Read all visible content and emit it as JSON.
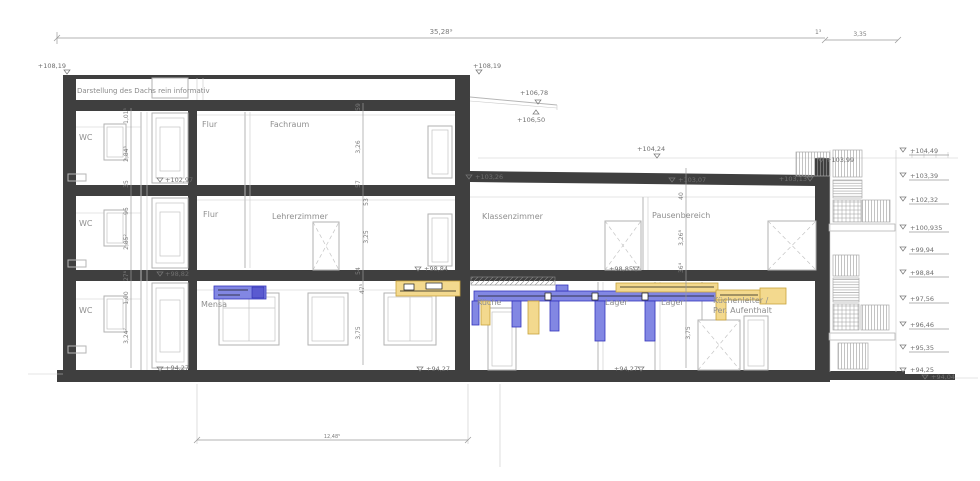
{
  "note": "Darstellung des Dachs rein informativ",
  "colors": {
    "wall": "#3f3f3f",
    "duct_supply_blue": "#8287e3",
    "duct_exhaust_yellow": "#f3d98e",
    "line_gray": "#b6b6b6"
  },
  "dims": {
    "top_main": "35,28⁹",
    "top_small": "1³",
    "top_right": "3,35",
    "bottom": "12,48⁵",
    "left": [
      "1,01⁵",
      "2,84⁵",
      "35",
      "95",
      "2,85²",
      "27⁸",
      "1,00",
      "3,24⁷"
    ],
    "mid": [
      "59",
      "3,26",
      "57",
      "53",
      "3,25",
      "54",
      "47⁵",
      "3,75"
    ],
    "right": [
      "40",
      "3,26⁸",
      "36⁴",
      "3,75"
    ]
  },
  "rooms": {
    "wc": "WC",
    "flur": "Flur",
    "fachraum": "Fachraum",
    "lehrerzimmer": "Lehrerzimmer",
    "klassenzimmer": "Klassenzimmer",
    "pausenbereich": "Pausenbereich",
    "mensa": "Mensa",
    "kueche": "Küche",
    "lager": "Lager",
    "kuechenleiter1": "Küchenleiter /",
    "kuechenleiter2": "Per. Aufenthalt"
  },
  "levels": {
    "parapet": "+108,19",
    "canopy_top": "+106,78",
    "canopy_bot": "+106,50",
    "roof2": "+104,24",
    "slab2_l": "+103,26",
    "slab2_m": "+103,07",
    "slab2_r": "+103,13",
    "stair_top": "+103,99",
    "stair_l1": "+102,97",
    "stair_l2": "+98,82",
    "floor1_l": "+98,84",
    "floor1_r": "+98,85",
    "ground": "+94,27",
    "terrain": "+94,04",
    "right_list": [
      "+104,49",
      "+103,39",
      "+102,32",
      "+100,935",
      "+99,94",
      "+98,84",
      "+97,56",
      "+96,46",
      "+95,35",
      "+94,25"
    ]
  }
}
